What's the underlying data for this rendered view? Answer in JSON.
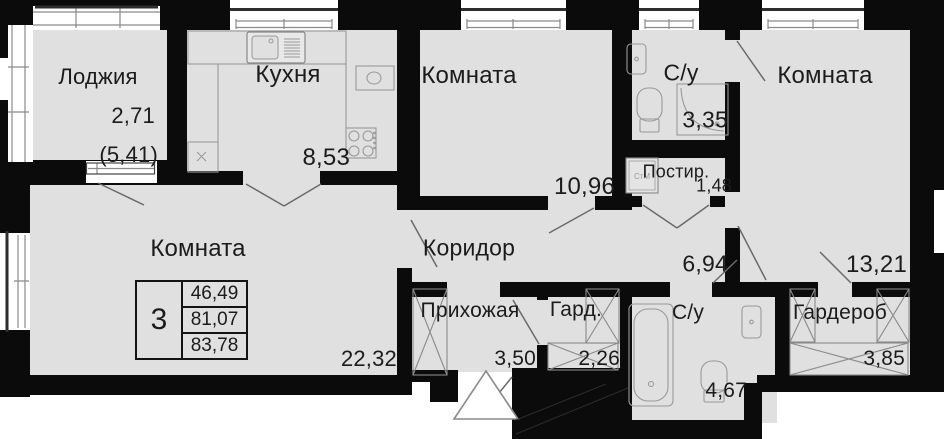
{
  "plan": {
    "rooms": [
      {
        "key": "loggia",
        "name": "Лоджия",
        "area": "2,71",
        "area_secondary": "(5,41)"
      },
      {
        "key": "kitchen",
        "name": "Кухня",
        "area": "8,53"
      },
      {
        "key": "bedroom-1",
        "name": "Комната",
        "area": "10,96"
      },
      {
        "key": "bathroom-1",
        "name": "С/у",
        "area": "3,35"
      },
      {
        "key": "bedroom-2",
        "name": "Комната",
        "area": "13,21"
      },
      {
        "key": "laundry",
        "name": "Постир.",
        "area": "1,48"
      },
      {
        "key": "corridor",
        "name": "Коридор",
        "area": "6,94"
      },
      {
        "key": "living-room",
        "name": "Комната",
        "area": "22,32"
      },
      {
        "key": "hallway",
        "name": "Прихожая",
        "area": "3,50"
      },
      {
        "key": "wardrobe-small",
        "name": "Гард.",
        "area": "2,26"
      },
      {
        "key": "bathroom-2",
        "name": "С/у",
        "area": "4,67"
      },
      {
        "key": "wardrobe",
        "name": "Гардероб",
        "area": "3,85"
      }
    ],
    "info_box": {
      "rooms_count": "3",
      "area_living": "46,49",
      "area_main": "81,07",
      "area_total": "83,78"
    },
    "fixtures": {
      "washing_machine_label": "СтМ"
    },
    "colors": {
      "wall": "#0b0b0b",
      "floor": "#e0e0e0",
      "window": "#ffffff",
      "thin_line": "#8a8a8a",
      "text": "#1b1b1b"
    }
  }
}
